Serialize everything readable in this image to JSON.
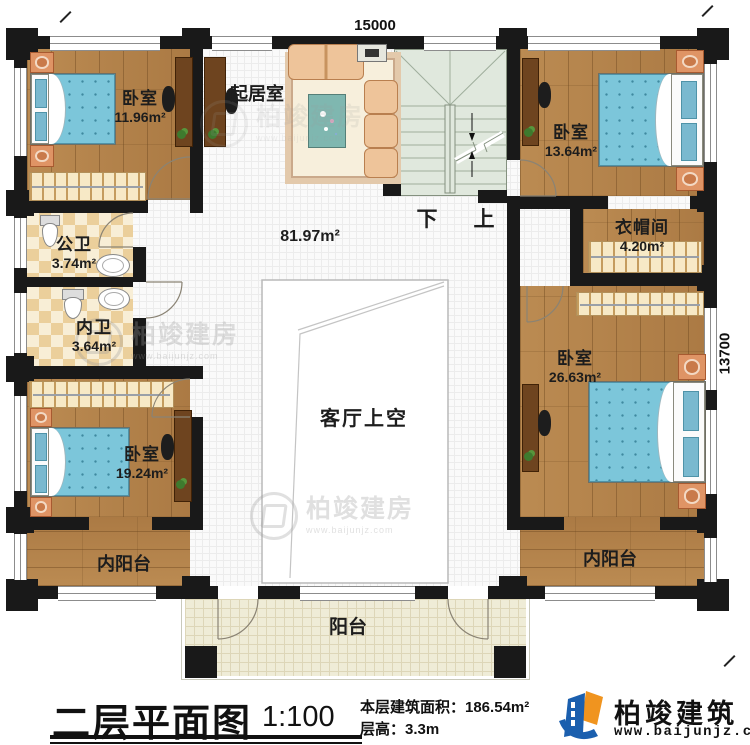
{
  "plan": {
    "dimensions": {
      "width_mm": "15000",
      "depth_mm": "13700"
    },
    "rooms": {
      "bedroom_tl": {
        "name": "卧室",
        "area": "11.96m²"
      },
      "living": {
        "name": "起居室"
      },
      "bedroom_tr": {
        "name": "卧室",
        "area": "13.64m²"
      },
      "cloakroom": {
        "name": "衣帽间",
        "area": "4.20m²"
      },
      "public_bath": {
        "name": "公卫",
        "area": "3.74m²"
      },
      "inner_bath": {
        "name": "内卫",
        "area": "3.64m²"
      },
      "bedroom_bl": {
        "name": "卧室",
        "area": "19.24m²"
      },
      "bedroom_r": {
        "name": "卧室",
        "area": "26.63m²"
      },
      "hall": {
        "area": "81.97m²"
      },
      "void": {
        "name": "客厅上空"
      },
      "inner_balcony_left": {
        "name": "内阳台"
      },
      "inner_balcony_right": {
        "name": "内阳台"
      },
      "balcony": {
        "name": "阳台"
      }
    },
    "stairs": {
      "down_label": "下",
      "up_label": "上"
    }
  },
  "watermark": {
    "text": "柏竣建房",
    "url": "www.baijunjz.com"
  },
  "footer": {
    "title": "二层平面图",
    "scale": "1:100",
    "area_line": "本层建筑面积：186.54m²",
    "height_line": "层高：3.3m",
    "brand": "柏竣建筑",
    "brand_url": "www.baijunjz.com"
  },
  "colors": {
    "wall": "#191919",
    "wood": "#b3824c",
    "bed_blue": "#7cc6da",
    "bath_tile": "#ebcf9b",
    "stair": "#e0e8dd",
    "balcony": "#efecd7",
    "logo_blue": "#1b5fae",
    "logo_orange": "#f0941f"
  }
}
